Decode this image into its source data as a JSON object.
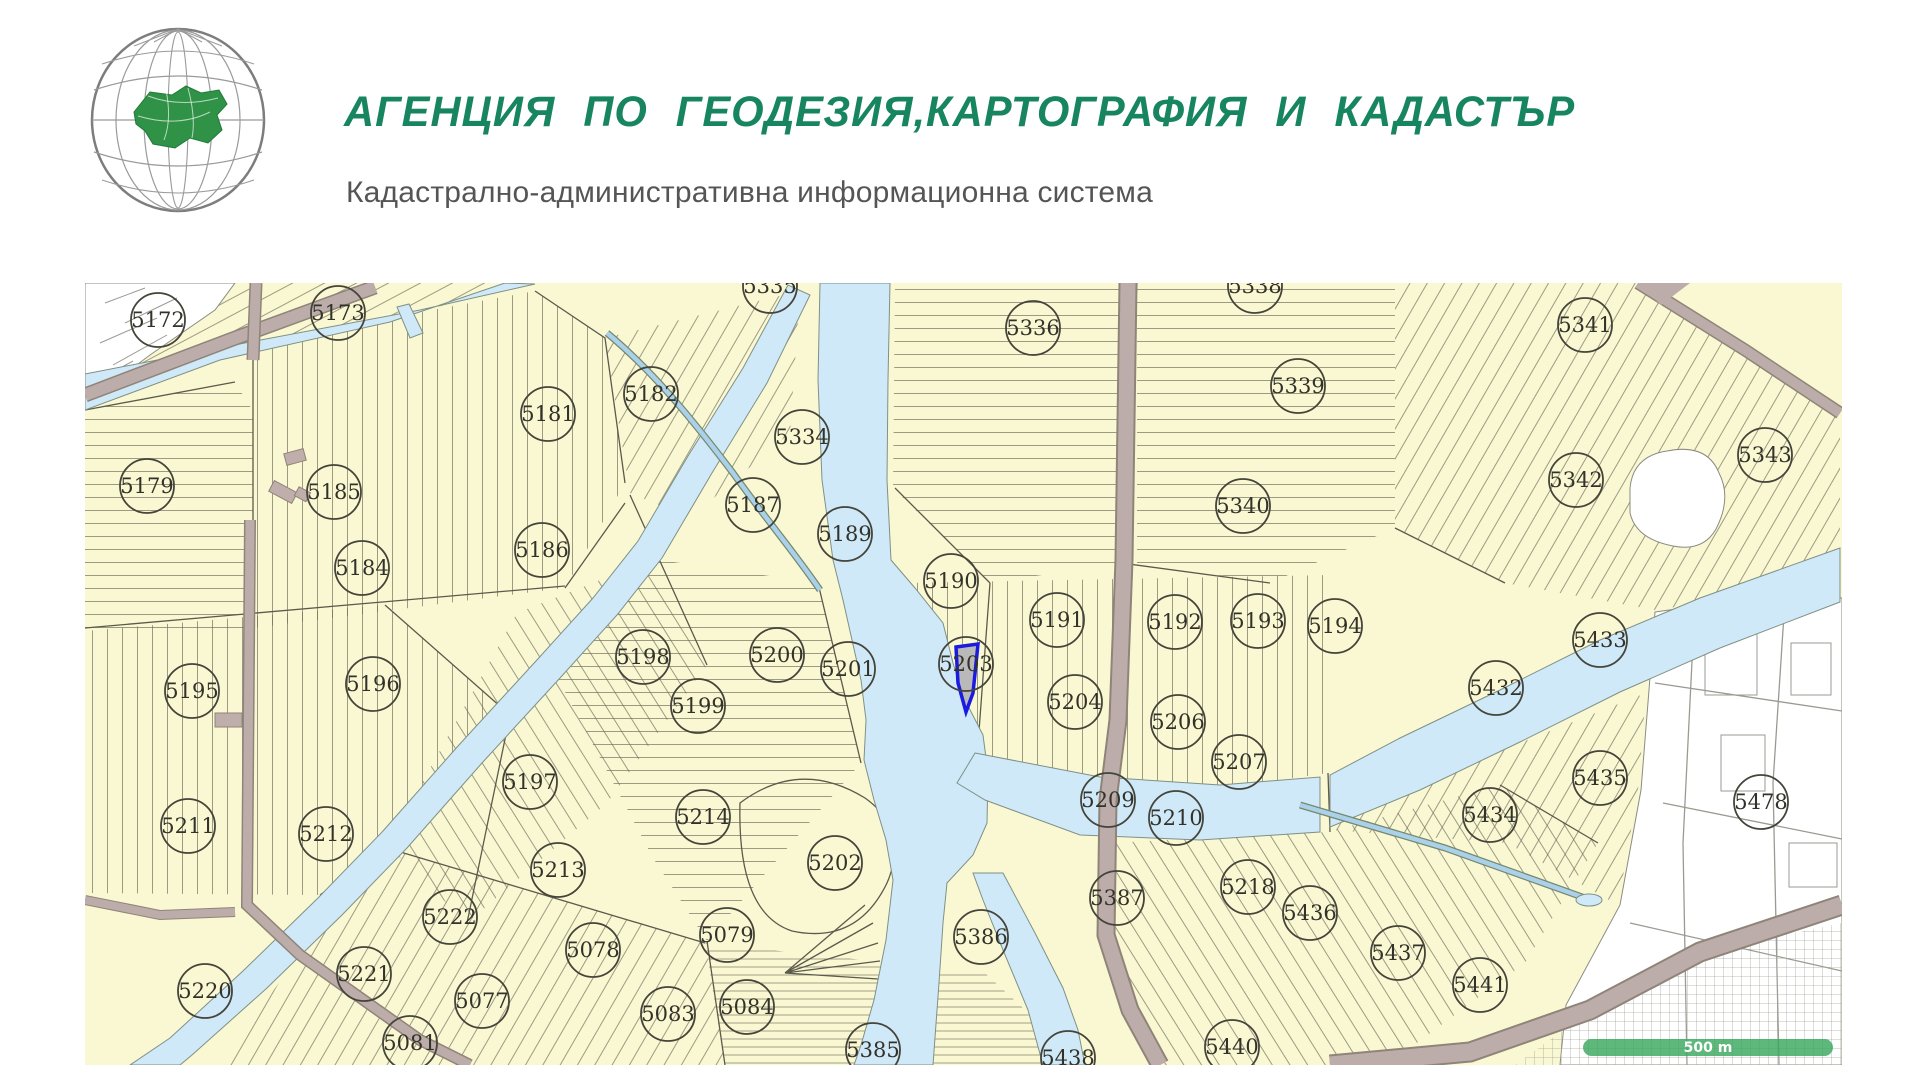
{
  "colors": {
    "title_green": "#17855f",
    "subtitle_gray": "#555555",
    "parcel_fill": "#faf8d2",
    "parcel_line": "#5b5a4c",
    "water": "#cfe9f8",
    "road": "#bcadab",
    "urban_white": "#ffffff",
    "circle_line": "#45443a",
    "label_text": "#33322a",
    "highlight_outline": "#1a1ae0",
    "highlight_fill": "#b9b9b9",
    "scalebar_green": "#3aa85f"
  },
  "header": {
    "title": "АГЕНЦИЯ ПО ГЕОДЕЗИЯ,КАРТОГРАФИЯ И КАДАСТЪР",
    "subtitle": "Кадастрално-административна информационна система"
  },
  "map": {
    "scale_bar_label": "500 m",
    "highlighted_parcel": {
      "number": "5203"
    },
    "parcel_markers": [
      {
        "n": "5172",
        "x": 158,
        "y": 320
      },
      {
        "n": "5173",
        "x": 338,
        "y": 313
      },
      {
        "n": "5335",
        "x": 770,
        "y": 286
      },
      {
        "n": "5336",
        "x": 1033,
        "y": 328
      },
      {
        "n": "5338",
        "x": 1255,
        "y": 286
      },
      {
        "n": "5341",
        "x": 1585,
        "y": 325
      },
      {
        "n": "5181",
        "x": 548,
        "y": 414
      },
      {
        "n": "5182",
        "x": 651,
        "y": 394
      },
      {
        "n": "5339",
        "x": 1298,
        "y": 386
      },
      {
        "n": "5334",
        "x": 802,
        "y": 437
      },
      {
        "n": "5343",
        "x": 1765,
        "y": 455
      },
      {
        "n": "5179",
        "x": 147,
        "y": 486
      },
      {
        "n": "5185",
        "x": 334,
        "y": 492
      },
      {
        "n": "5187",
        "x": 753,
        "y": 505
      },
      {
        "n": "5189",
        "x": 845,
        "y": 534
      },
      {
        "n": "5342",
        "x": 1576,
        "y": 480
      },
      {
        "n": "5340",
        "x": 1243,
        "y": 506
      },
      {
        "n": "5184",
        "x": 362,
        "y": 568
      },
      {
        "n": "5186",
        "x": 542,
        "y": 550
      },
      {
        "n": "5190",
        "x": 951,
        "y": 581
      },
      {
        "n": "5191",
        "x": 1057,
        "y": 620
      },
      {
        "n": "5192",
        "x": 1175,
        "y": 622
      },
      {
        "n": "5193",
        "x": 1258,
        "y": 621
      },
      {
        "n": "5194",
        "x": 1335,
        "y": 626
      },
      {
        "n": "5433",
        "x": 1600,
        "y": 640
      },
      {
        "n": "5198",
        "x": 643,
        "y": 657
      },
      {
        "n": "5200",
        "x": 777,
        "y": 655
      },
      {
        "n": "5201",
        "x": 848,
        "y": 669
      },
      {
        "n": "5203",
        "x": 966,
        "y": 664
      },
      {
        "n": "5196",
        "x": 373,
        "y": 684
      },
      {
        "n": "5195",
        "x": 192,
        "y": 691
      },
      {
        "n": "5199",
        "x": 698,
        "y": 706
      },
      {
        "n": "5204",
        "x": 1075,
        "y": 702
      },
      {
        "n": "5206",
        "x": 1178,
        "y": 722
      },
      {
        "n": "5432",
        "x": 1496,
        "y": 688
      },
      {
        "n": "5207",
        "x": 1239,
        "y": 762
      },
      {
        "n": "5197",
        "x": 530,
        "y": 782
      },
      {
        "n": "5209",
        "x": 1108,
        "y": 800
      },
      {
        "n": "5210",
        "x": 1176,
        "y": 818
      },
      {
        "n": "5435",
        "x": 1600,
        "y": 778
      },
      {
        "n": "5434",
        "x": 1490,
        "y": 815
      },
      {
        "n": "5478",
        "x": 1761,
        "y": 802
      },
      {
        "n": "5214",
        "x": 703,
        "y": 817
      },
      {
        "n": "5211",
        "x": 188,
        "y": 826
      },
      {
        "n": "5212",
        "x": 326,
        "y": 834
      },
      {
        "n": "5213",
        "x": 558,
        "y": 870
      },
      {
        "n": "5202",
        "x": 835,
        "y": 863
      },
      {
        "n": "5218",
        "x": 1248,
        "y": 887
      },
      {
        "n": "5387",
        "x": 1117,
        "y": 898
      },
      {
        "n": "5436",
        "x": 1310,
        "y": 913
      },
      {
        "n": "5222",
        "x": 450,
        "y": 917
      },
      {
        "n": "5386",
        "x": 981,
        "y": 937
      },
      {
        "n": "5078",
        "x": 593,
        "y": 950
      },
      {
        "n": "5079",
        "x": 727,
        "y": 935
      },
      {
        "n": "5437",
        "x": 1398,
        "y": 953
      },
      {
        "n": "5221",
        "x": 364,
        "y": 974
      },
      {
        "n": "5077",
        "x": 482,
        "y": 1001
      },
      {
        "n": "5441",
        "x": 1480,
        "y": 985
      },
      {
        "n": "5220",
        "x": 205,
        "y": 991
      },
      {
        "n": "5083",
        "x": 668,
        "y": 1014
      },
      {
        "n": "5084",
        "x": 747,
        "y": 1007
      },
      {
        "n": "5081",
        "x": 410,
        "y": 1043
      },
      {
        "n": "5385",
        "x": 873,
        "y": 1050
      },
      {
        "n": "5438",
        "x": 1068,
        "y": 1058
      },
      {
        "n": "5440",
        "x": 1232,
        "y": 1047
      }
    ]
  }
}
